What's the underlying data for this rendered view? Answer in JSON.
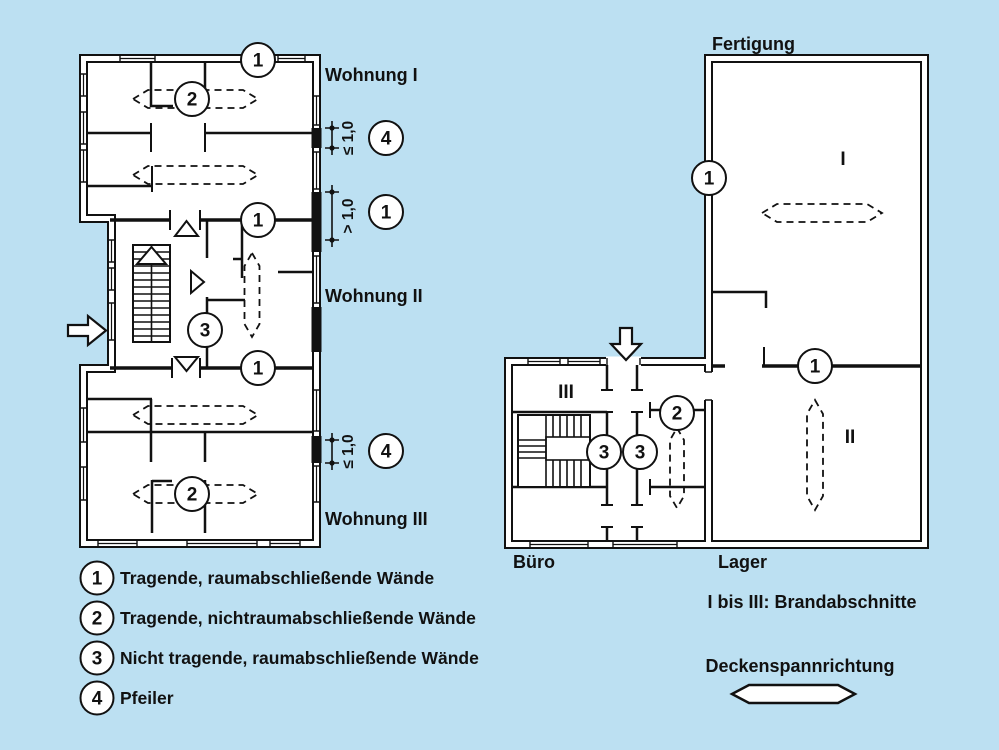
{
  "colors": {
    "background": "#bce0f2",
    "line": "#111111",
    "plan_fill": "#ffffff"
  },
  "left_plan": {
    "apartments": [
      "Wohnung I",
      "Wohnung II",
      "Wohnung III"
    ],
    "markers": [
      "1",
      "2",
      "4",
      "1",
      "1",
      "3",
      "1",
      "2",
      "4"
    ],
    "dimensions": [
      "≤ 1,0",
      "> 1,0",
      "≤ 1,0"
    ]
  },
  "right_plan": {
    "building_label": "Fertigung",
    "area_labels": [
      "Büro",
      "Lager"
    ],
    "compartments": [
      "I",
      "II",
      "III"
    ],
    "markers": [
      "1",
      "1",
      "2",
      "3",
      "3"
    ]
  },
  "legend": [
    {
      "number": "1",
      "label": "Tragende, raumabschließende Wände"
    },
    {
      "number": "2",
      "label": "Tragende, nichtraumabschließende Wände"
    },
    {
      "number": "3",
      "label": "Nicht tragende, raumabschließende Wände"
    },
    {
      "number": "4",
      "label": "Pfeiler"
    }
  ],
  "captions": {
    "fire_compartments": "I bis III: Brandabschnitte",
    "span_direction": "Deckenspannrichtung"
  }
}
